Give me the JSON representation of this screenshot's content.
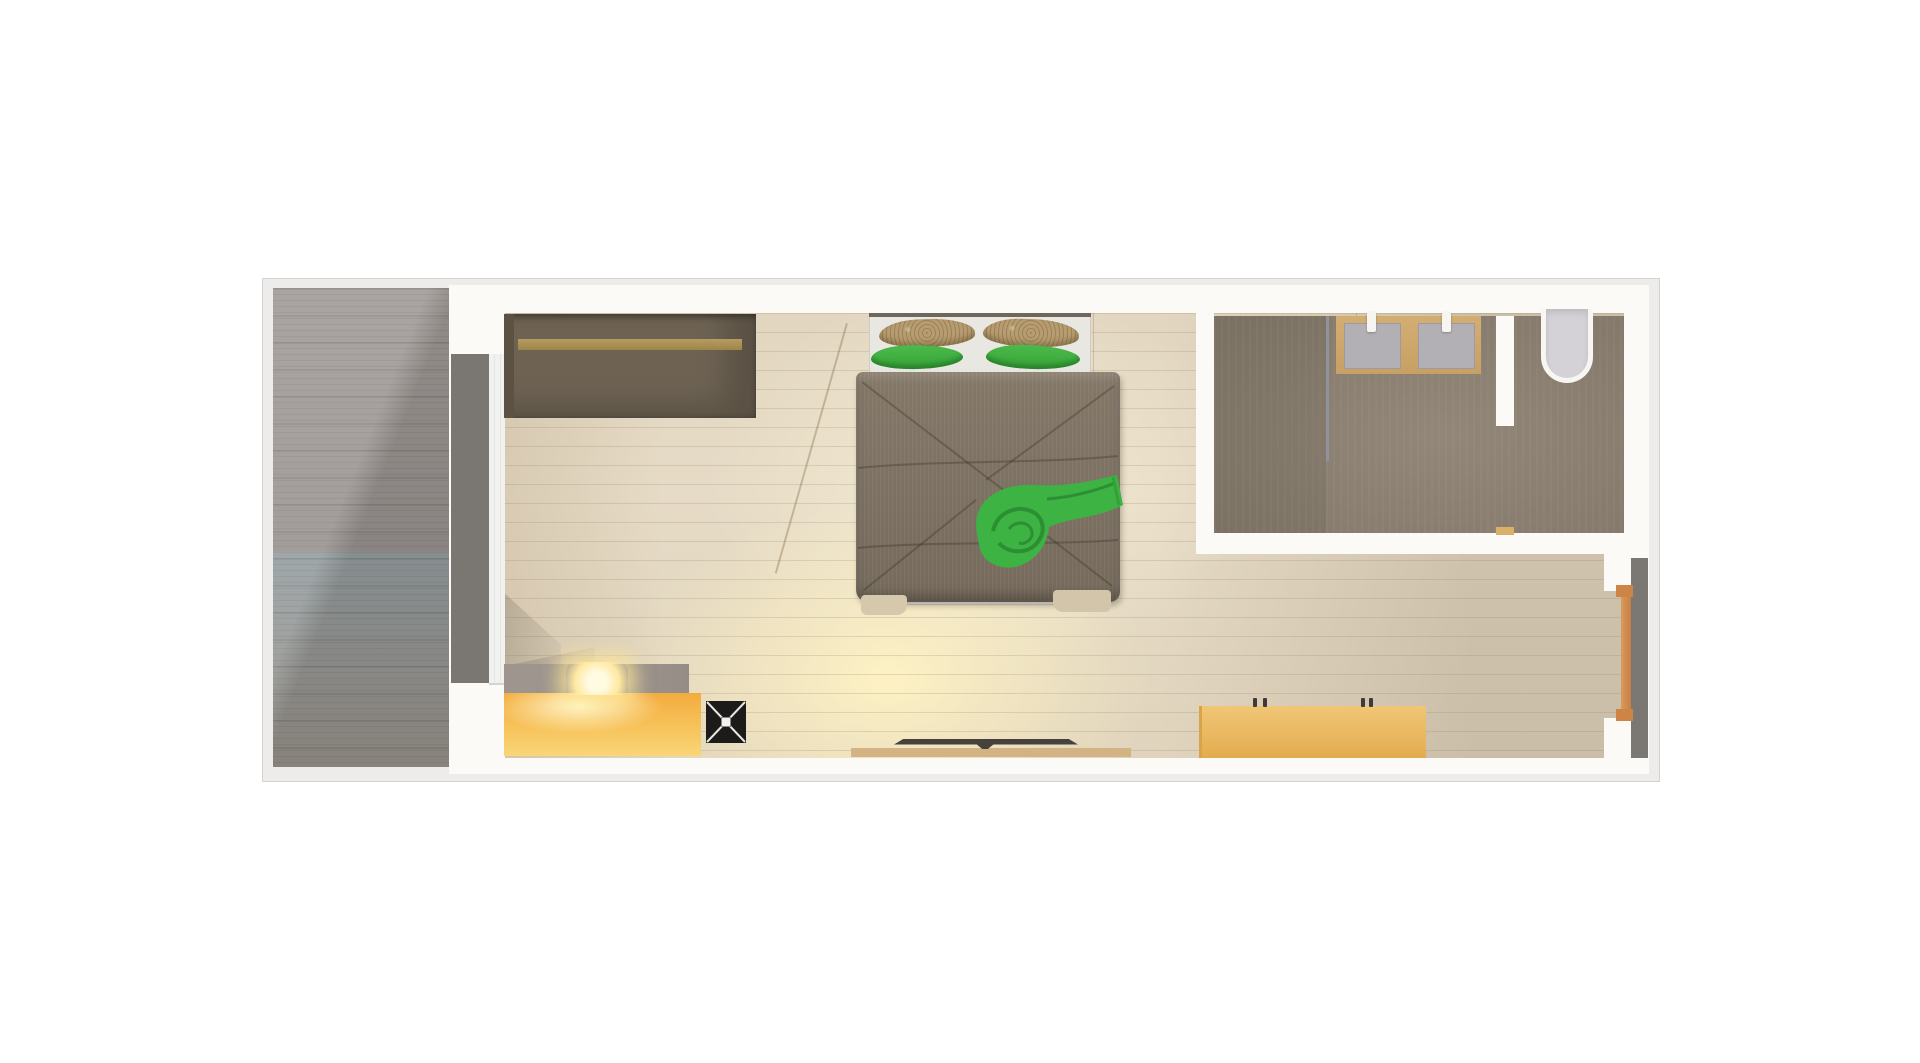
{
  "scene": {
    "kind": "architectural-floor-plan-top-view-render",
    "background_color": "#ffffff",
    "visible_text": "none"
  },
  "plan": {
    "frame_color": "#edecea",
    "wall_color": "#fbfaf7",
    "outline_color": "#d3d2ce"
  },
  "rooms": [
    {
      "name": "deck",
      "floor": "gray wood planks",
      "color": "#9b9492",
      "position": "left strip full height"
    },
    {
      "name": "main-room",
      "floor": "light warm wood planks with lamp glow",
      "color": "#e3d8c2",
      "position": "center"
    },
    {
      "name": "bathroom",
      "floor": "taupe brown",
      "color": "#8b7f70",
      "position": "top right"
    }
  ],
  "furniture": [
    {
      "name": "wardrobe",
      "color": "#6e6353",
      "detail_color_rail": "#ac9156",
      "position": "top left of main room"
    },
    {
      "name": "double-bed",
      "mattress_color": "#e9e7e2",
      "duvet_color": "#7d7264",
      "position": "top center"
    },
    {
      "name": "pillow-tan-left",
      "color": "#b79c6f"
    },
    {
      "name": "pillow-tan-right",
      "color": "#b79c6f"
    },
    {
      "name": "pillow-green-left",
      "color": "#3cb043"
    },
    {
      "name": "pillow-green-right",
      "color": "#3cb043"
    },
    {
      "name": "green-throw-blanket",
      "color": "#3cb343",
      "position": "right side of duvet"
    },
    {
      "name": "sliding-door",
      "color": "#7a7672",
      "position": "left wall between deck and main room"
    },
    {
      "name": "vanity-counter",
      "color": "#cda76a",
      "position": "bathroom top"
    },
    {
      "name": "sink-left",
      "color": "#b2b0b4"
    },
    {
      "name": "sink-right",
      "color": "#b2b0b4"
    },
    {
      "name": "bathtub",
      "color": "#d4d2d6",
      "position": "bathroom top right"
    },
    {
      "name": "shower-screen",
      "color": "#8f939b"
    },
    {
      "name": "kitchen-counter-glowing",
      "color": "#f7c35b",
      "position": "bottom left"
    },
    {
      "name": "kitchen-counter-gray",
      "color": "#9d958e"
    },
    {
      "name": "lamp",
      "color": "#ffe9a2"
    },
    {
      "name": "stove",
      "color": "#1d1b1a",
      "marking": "white X with center square"
    },
    {
      "name": "wall-shelf",
      "color": "#d3b284",
      "ledge_color": "#46413b",
      "position": "bottom center"
    },
    {
      "name": "kitchen-island",
      "color": "#e9b75f",
      "position": "bottom right"
    },
    {
      "name": "window-door-right",
      "frame_color": "#cd8546",
      "position": "right wall lower"
    }
  ],
  "lighting": {
    "glow_center_color": "#fff3c4",
    "shadow_color": "rgba(92,86,78,0.30)",
    "sun_line": "faint diagonal line across center floor"
  }
}
